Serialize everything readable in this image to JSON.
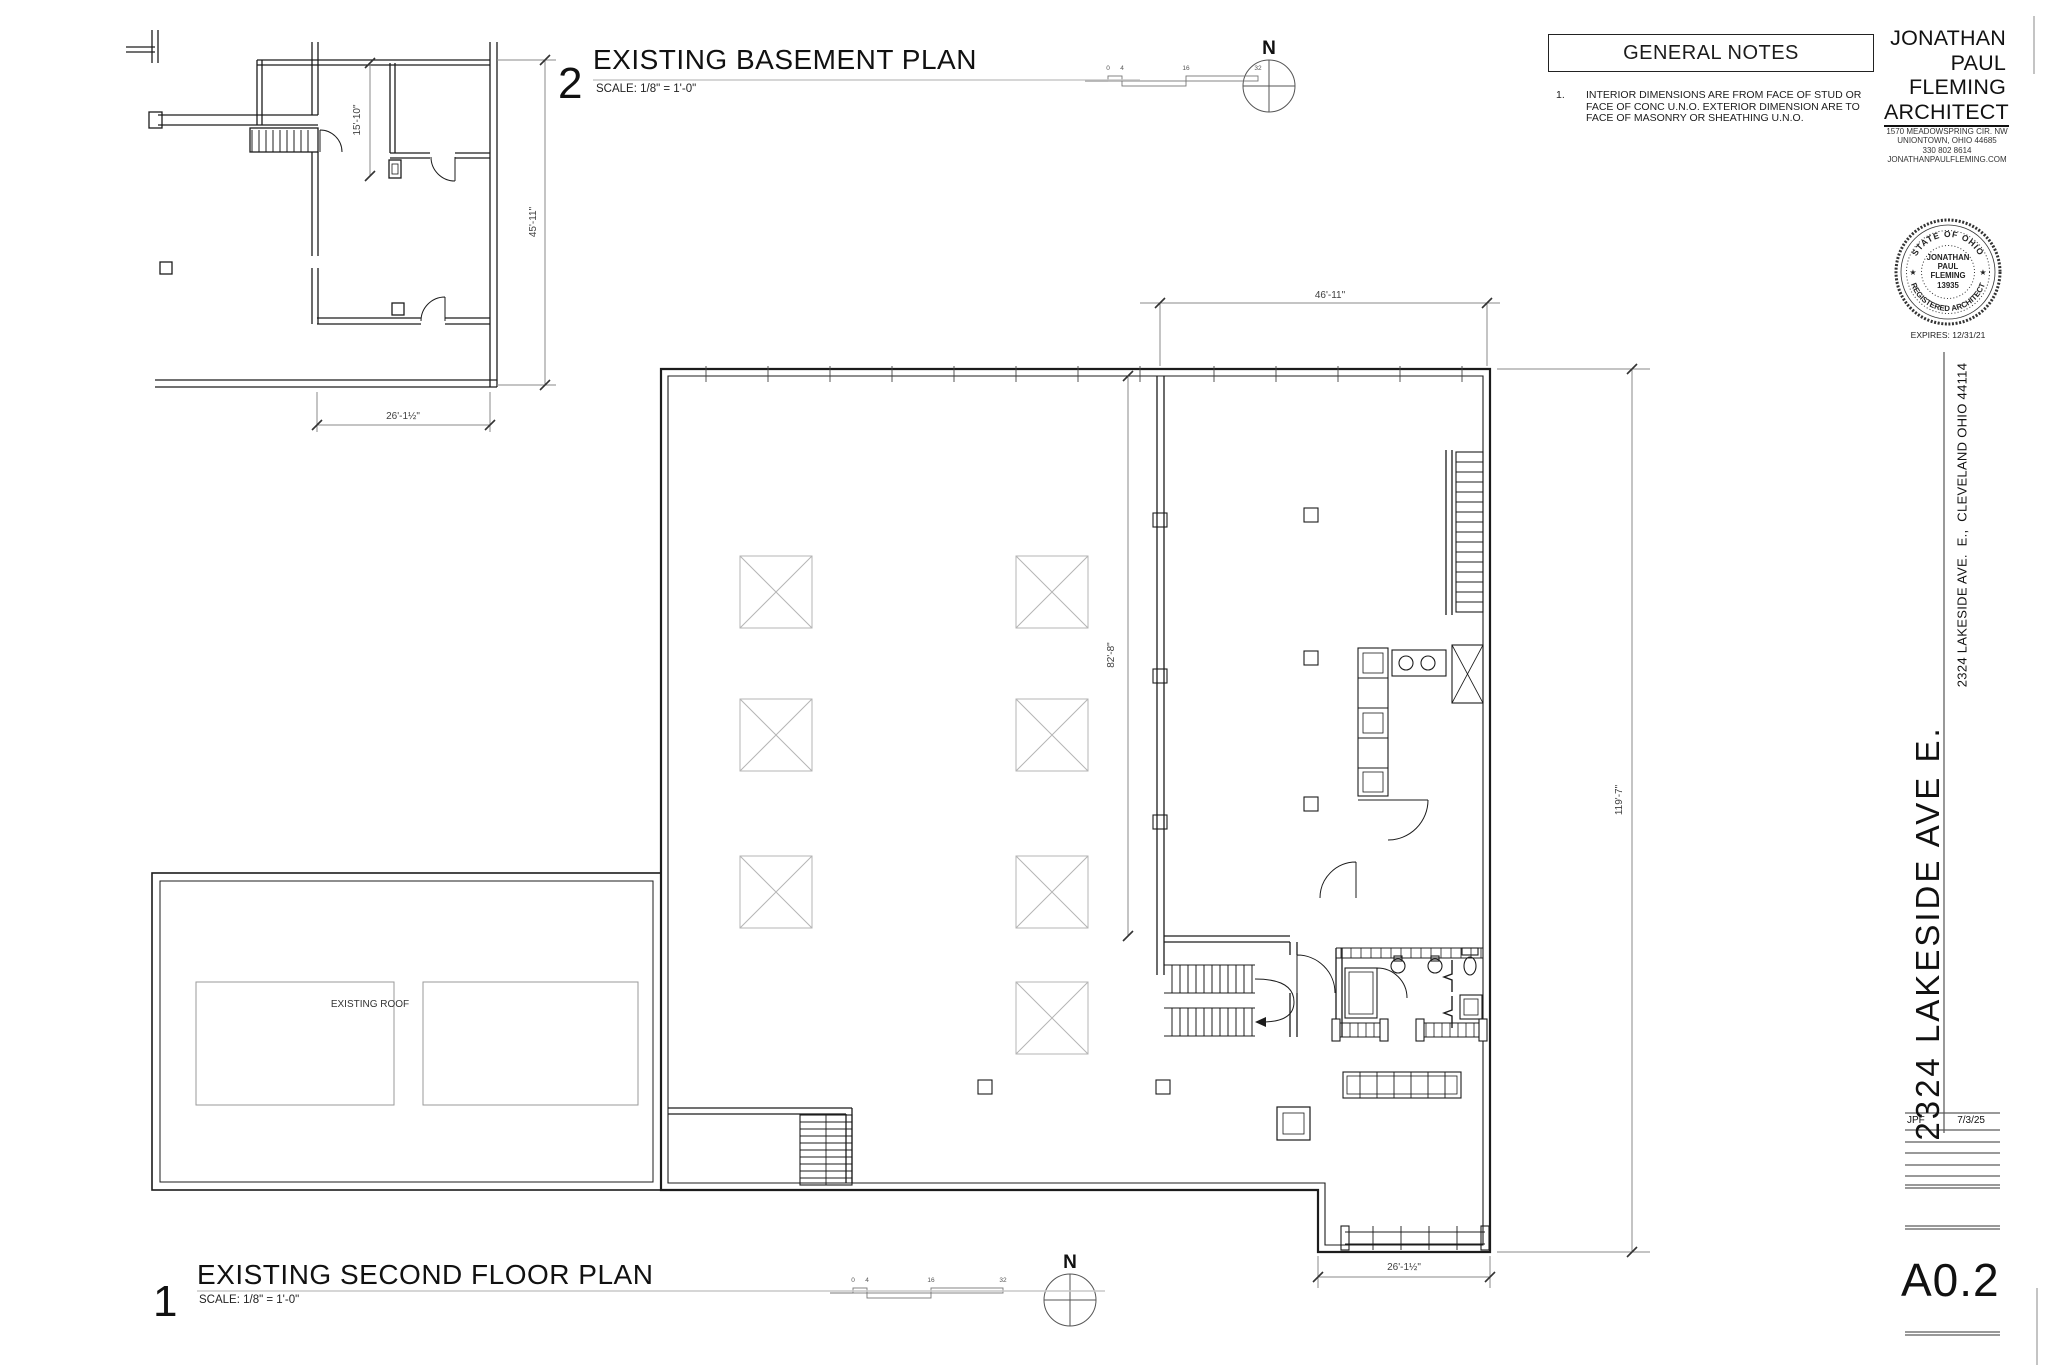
{
  "colors": {
    "ink": "#1c1c1c",
    "dim_line": "#8a8a8a",
    "light_line": "#bdbdbd"
  },
  "north_label": "N",
  "scale_bar": {
    "ticks": [
      "0",
      "4",
      "16",
      "32"
    ]
  },
  "plan_titles": {
    "basement": {
      "number": "2",
      "title": "EXISTING BASEMENT PLAN",
      "scale": "SCALE: 1/8\" = 1'-0\""
    },
    "second_floor": {
      "number": "1",
      "title": "EXISTING SECOND FLOOR PLAN",
      "scale": "SCALE: 1/8\" = 1'-0\""
    }
  },
  "general_notes": {
    "title": "GENERAL NOTES",
    "items": [
      {
        "num": "1.",
        "text": "INTERIOR DIMENSIONS ARE FROM FACE OF STUD OR FACE OF CONC U.N.O. EXTERIOR DIMENSION ARE TO FACE OF MASONRY OR SHEATHING U.N.O."
      }
    ]
  },
  "architect": {
    "name_lines": [
      "JONATHAN",
      "PAUL",
      "FLEMING",
      "ARCHITECT"
    ],
    "address_lines": [
      "1570 MEADOWSPRING CIR. NW",
      "UNIONTOWN, OHIO 44685",
      "330 802 8614",
      "JONATHANPAULFLEMING.COM"
    ]
  },
  "seal": {
    "arc_top": "STATE OF OHIO",
    "arc_bottom": "REGISTERED ARCHITECT",
    "center_lines": [
      "JONATHAN",
      "PAUL",
      "FLEMING",
      "13935"
    ],
    "star": "★",
    "expires": "EXPIRES: 12/31/21"
  },
  "title_block": {
    "address_small": "2324 LAKESIDE AVE.  E.,  CLEVELAND OHIO 44114",
    "address_large": "2324 LAKESIDE AVE E.",
    "initials": "JPF",
    "date": "7/3/25",
    "sheet_number": "A0.2"
  },
  "labels": {
    "existing_roof": "EXISTING ROOF"
  },
  "dimensions": {
    "basement_room_depth": "15'-10\"",
    "basement_side": "45'-11\"",
    "basement_width": "26'-1½\"",
    "sf_wing_width": "46'-11\"",
    "sf_interior_depth": "82'-8\"",
    "sf_side": "119'-7\"",
    "sf_bottom_width": "26'-1½\""
  }
}
